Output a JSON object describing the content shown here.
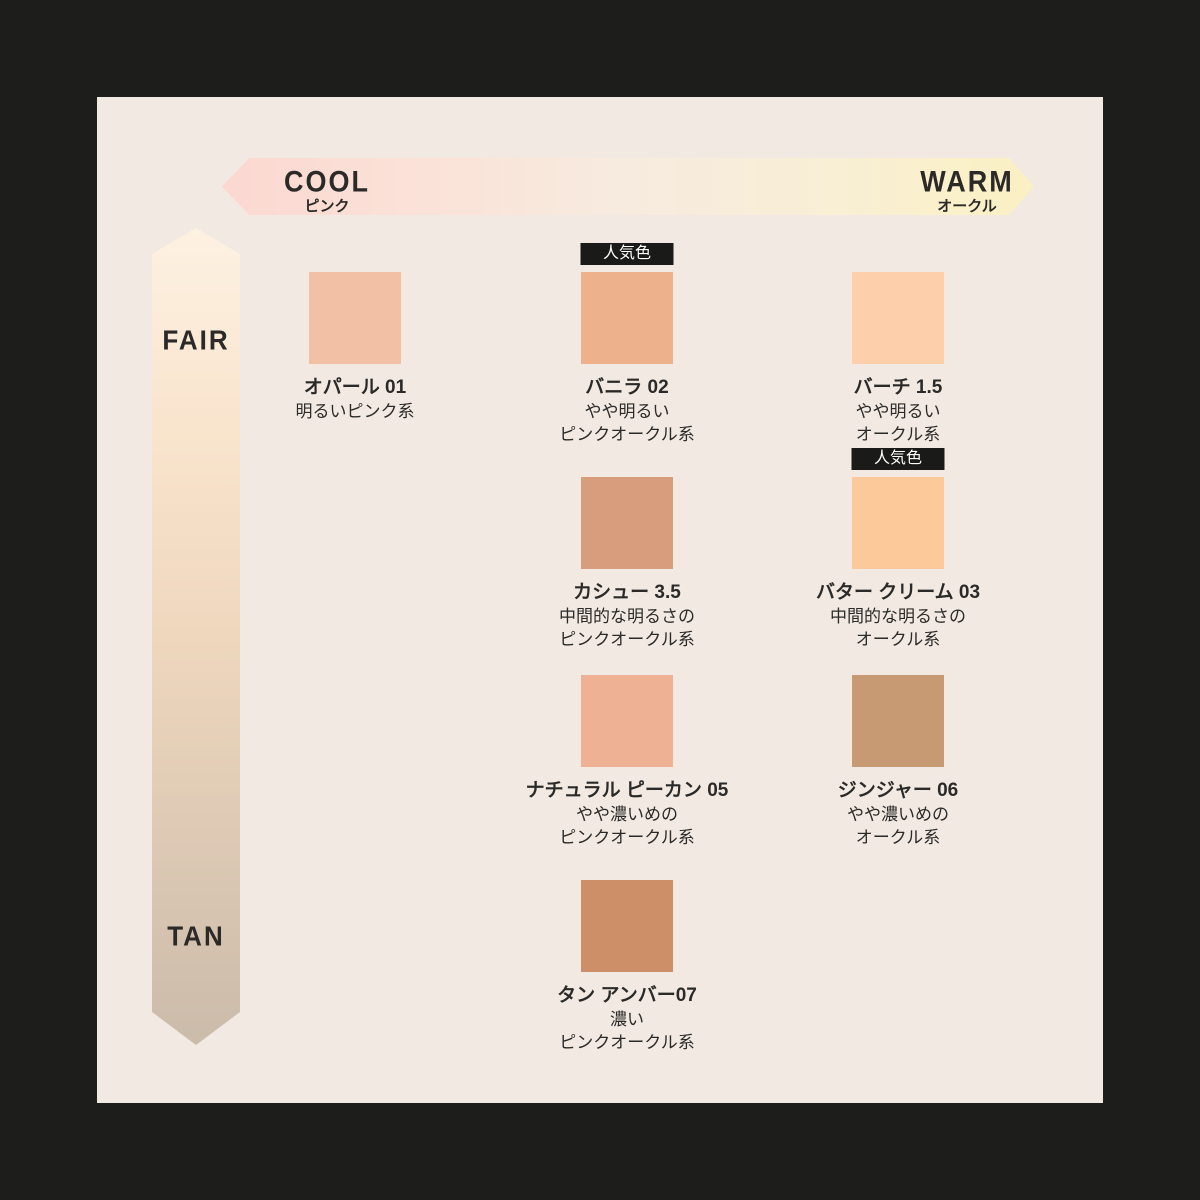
{
  "panel": {
    "background": "#f2eae2",
    "outer_background": "#1d1d1b"
  },
  "axes": {
    "horizontal": {
      "left_label": "COOL",
      "left_sublabel": "ピンク",
      "right_label": "WARM",
      "right_sublabel": "オークル",
      "gradient": [
        "#fbd8d1",
        "#fbe2d8",
        "#f7ebdf",
        "#f8efd5",
        "#fbf0c3"
      ]
    },
    "vertical": {
      "top_label": "FAIR",
      "bottom_label": "TAN",
      "gradient": [
        "#fdf1e2",
        "#f9e4cd",
        "#eed7bd",
        "#ddc9b4",
        "#cbbbaa"
      ]
    }
  },
  "badge_label": "人気色",
  "badge_colors": {
    "background": "#1a1a18",
    "text": "#ffffff"
  },
  "shades": [
    {
      "name": "オパール 01",
      "desc1": "明るいピンク系",
      "desc2": "",
      "color": "#f2c0a4",
      "popular": false
    },
    {
      "name": "バニラ 02",
      "desc1": "やや明るい",
      "desc2": "ピンクオークル系",
      "color": "#edb18b",
      "popular": true
    },
    {
      "name": "バーチ 1.5",
      "desc1": "やや明るい",
      "desc2": "オークル系",
      "color": "#fdd0ab",
      "popular": false
    },
    {
      "name": "カシュー 3.5",
      "desc1": "中間的な明るさの",
      "desc2": "ピンクオークル系",
      "color": "#d89d7c",
      "popular": false
    },
    {
      "name": "バター クリーム 03",
      "desc1": "中間的な明るさの",
      "desc2": "オークル系",
      "color": "#fcc99b",
      "popular": true
    },
    {
      "name": "ナチュラル ピーカン 05",
      "desc1": "やや濃いめの",
      "desc2": "ピンクオークル系",
      "color": "#eeb194",
      "popular": false
    },
    {
      "name": "ジンジャー 06",
      "desc1": "やや濃いめの",
      "desc2": "オークル系",
      "color": "#c79a74",
      "popular": false
    },
    {
      "name": "タン アンバー07",
      "desc1": "濃い",
      "desc2": "ピンクオークル系",
      "color": "#cc8f68",
      "popular": false
    }
  ]
}
